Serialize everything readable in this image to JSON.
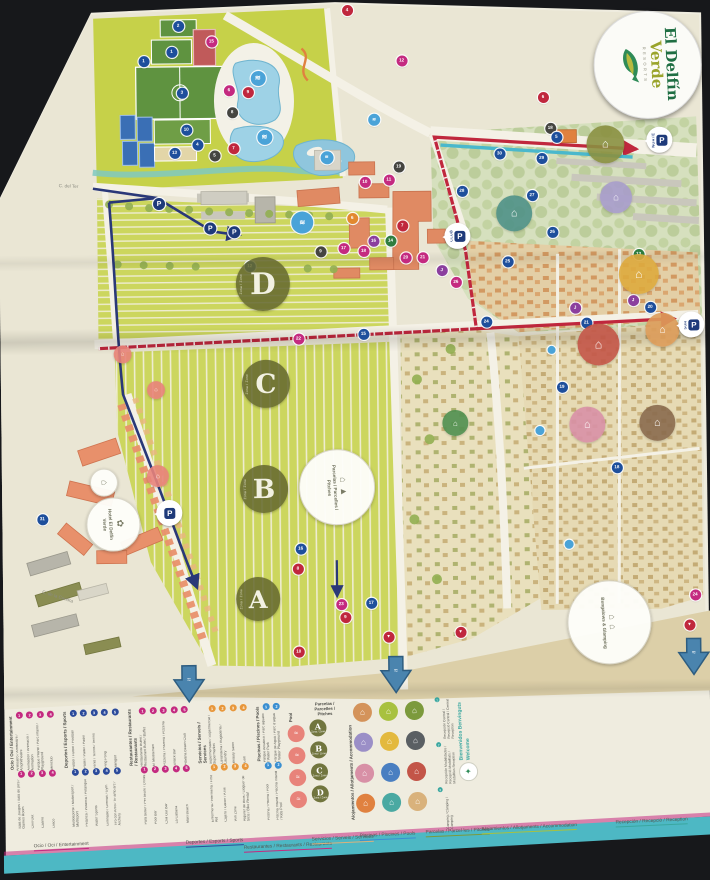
{
  "brand": {
    "line1": "El Delfín",
    "line2": "Verde",
    "tagline": "RESORTS",
    "dolphin_icon": "dolphin-icon"
  },
  "palette": {
    "b": "#1e4f9c",
    "lb": "#4aa3d8",
    "m": "#c42a80",
    "r": "#c0273d",
    "p": "#8b3f9e",
    "o": "#e2892f",
    "g": "#2f7d3f",
    "k": "#454541",
    "t": "#2ba6b4",
    "route_red": "#c0273d",
    "route_blue": "#2a3878",
    "route_teal": "#4ab8cc",
    "paper": "#efecdf",
    "lime": "#ccd65e",
    "sports": "#c6d149",
    "pool": "#9ed2e6"
  },
  "map": {
    "zone_circles": [
      {
        "letter": "D",
        "sub": "Zona / Zone",
        "x": 265,
        "y": 283,
        "r": 27
      },
      {
        "letter": "C",
        "sub": "Zona / Zone",
        "x": 267,
        "y": 383,
        "r": 24
      },
      {
        "letter": "B",
        "sub": "Zona / Zone",
        "x": 264,
        "y": 488,
        "r": 24
      },
      {
        "letter": "A",
        "sub": "Zona / Zone",
        "x": 257,
        "y": 598,
        "r": 22
      }
    ],
    "label_circles": [
      {
        "id": "pitches",
        "x": 336,
        "y": 486,
        "r": 37,
        "icons": "⌂ ▲",
        "text": "Parcelas / Parcelles / Pitches"
      },
      {
        "id": "bungalows",
        "x": 607,
        "y": 624,
        "r": 41,
        "icons": "⌂ ⌂",
        "text": "Bungalows & Glamping"
      },
      {
        "id": "hotel",
        "x": 112,
        "y": 521,
        "r": 26,
        "icons": "✿",
        "text": "Hotel El Delfín Verde"
      },
      {
        "id": "house",
        "x": 103,
        "y": 479,
        "r": 13,
        "icons": "⌂",
        "text": ""
      }
    ],
    "colored_circles": [
      {
        "x": 609,
        "y": 147,
        "r": 19,
        "c": "#8a9040",
        "g": "⌂"
      },
      {
        "x": 619,
        "y": 200,
        "r": 16,
        "c": "#a79ccb",
        "g": "⌂"
      },
      {
        "x": 517,
        "y": 215,
        "r": 18,
        "c": "#4f9187",
        "g": "⌂"
      },
      {
        "x": 641,
        "y": 277,
        "r": 20,
        "c": "#ddaa3e",
        "g": "⌂"
      },
      {
        "x": 600,
        "y": 347,
        "r": 21,
        "c": "#c35548",
        "g": "⌂"
      },
      {
        "x": 664,
        "y": 333,
        "r": 17,
        "c": "#dd9c5a",
        "g": "⌂"
      },
      {
        "x": 588,
        "y": 427,
        "r": 18,
        "c": "#d890a6",
        "g": "⌂"
      },
      {
        "x": 658,
        "y": 426,
        "r": 18,
        "c": "#8a6a4e",
        "g": "⌂"
      },
      {
        "x": 456,
        "y": 424,
        "r": 13,
        "c": "#4f8f4f",
        "g": "⌂"
      },
      {
        "x": 158,
        "y": 474,
        "r": 11,
        "c": "#e8837a",
        "g": "⌂"
      },
      {
        "x": 124,
        "y": 352,
        "r": 9,
        "c": "#e8837a",
        "g": "⌂"
      },
      {
        "x": 157,
        "y": 388,
        "r": 9,
        "c": "#e8837a",
        "g": "⌂"
      }
    ],
    "parkings": [
      {
        "label": "P",
        "name": "NORTE",
        "x": 650,
        "y": 130
      },
      {
        "label": "P",
        "name": "CLUB",
        "x": 447,
        "y": 224
      },
      {
        "label": "P",
        "name": "SUR",
        "x": 680,
        "y": 315
      },
      {
        "label": "P",
        "name": "",
        "x": 156,
        "y": 498
      }
    ],
    "p_dots": [
      {
        "x": 162,
        "y": 202
      },
      {
        "x": 213,
        "y": 227
      },
      {
        "x": 237,
        "y": 231
      }
    ],
    "streets": [
      {
        "text": "C. del Ter",
        "x": 62,
        "y": 180,
        "rot": 3
      },
      {
        "text": "C. de la Cendra",
        "x": 2,
        "y": 238,
        "rot": 90
      },
      {
        "text": "C. de la Cendra",
        "x": 42,
        "y": 586,
        "rot": 18
      }
    ],
    "beach_arrows": [
      {
        "x": 170,
        "y": 662
      },
      {
        "x": 377,
        "y": 655
      },
      {
        "x": 675,
        "y": 640
      }
    ],
    "markers": [
      {
        "x": 183,
        "y": 24,
        "c": "b",
        "t": "2"
      },
      {
        "x": 176,
        "y": 50,
        "c": "b",
        "t": "1"
      },
      {
        "x": 148,
        "y": 59,
        "c": "b",
        "t": "1"
      },
      {
        "x": 186,
        "y": 91,
        "c": "b",
        "t": "3"
      },
      {
        "x": 190,
        "y": 128,
        "c": "b",
        "t": "10"
      },
      {
        "x": 201,
        "y": 143,
        "c": "b",
        "t": "4"
      },
      {
        "x": 178,
        "y": 151,
        "c": "b",
        "t": "13"
      },
      {
        "x": 216,
        "y": 40,
        "c": "m",
        "t": "15"
      },
      {
        "x": 233,
        "y": 89,
        "c": "m",
        "t": "6"
      },
      {
        "x": 252,
        "y": 91,
        "c": "r",
        "t": "9"
      },
      {
        "x": 236,
        "y": 111,
        "c": "k",
        "t": "8"
      },
      {
        "x": 237,
        "y": 147,
        "c": "r",
        "t": "7"
      },
      {
        "x": 218,
        "y": 154,
        "c": "k",
        "t": "5"
      },
      {
        "x": 262,
        "y": 77,
        "c": "lb",
        "t": "≋",
        "s": 15
      },
      {
        "x": 268,
        "y": 136,
        "c": "lb",
        "t": "≋",
        "s": 15
      },
      {
        "x": 305,
        "y": 222,
        "c": "lb",
        "t": "≋",
        "s": 22
      },
      {
        "x": 330,
        "y": 157,
        "c": "lb",
        "t": "≋",
        "s": 13
      },
      {
        "x": 378,
        "y": 120,
        "c": "lb",
        "t": "≋",
        "s": 12
      },
      {
        "x": 352,
        "y": 10,
        "c": "r",
        "t": "4"
      },
      {
        "x": 406,
        "y": 61,
        "c": "m",
        "t": "12"
      },
      {
        "x": 547,
        "y": 99,
        "c": "r",
        "t": "6"
      },
      {
        "x": 554,
        "y": 130,
        "c": "k",
        "t": "18"
      },
      {
        "x": 560,
        "y": 139,
        "c": "b",
        "t": "5"
      },
      {
        "x": 503,
        "y": 155,
        "c": "b",
        "t": "30"
      },
      {
        "x": 545,
        "y": 160,
        "c": "b",
        "t": "29"
      },
      {
        "x": 465,
        "y": 192,
        "c": "b",
        "t": "28"
      },
      {
        "x": 535,
        "y": 197,
        "c": "b",
        "t": "27"
      },
      {
        "x": 555,
        "y": 234,
        "c": "b",
        "t": "26"
      },
      {
        "x": 510,
        "y": 263,
        "c": "b",
        "t": "25"
      },
      {
        "x": 488,
        "y": 323,
        "c": "b",
        "t": "24"
      },
      {
        "x": 402,
        "y": 167,
        "c": "k",
        "t": "19"
      },
      {
        "x": 392,
        "y": 180,
        "c": "m",
        "t": "11"
      },
      {
        "x": 368,
        "y": 182,
        "c": "m",
        "t": "10"
      },
      {
        "x": 355,
        "y": 218,
        "c": "o",
        "t": "6"
      },
      {
        "x": 405,
        "y": 226,
        "c": "r",
        "t": "7"
      },
      {
        "x": 376,
        "y": 241,
        "c": "p",
        "t": "16"
      },
      {
        "x": 393,
        "y": 241,
        "c": "g",
        "t": "14"
      },
      {
        "x": 346,
        "y": 248,
        "c": "m",
        "t": "17"
      },
      {
        "x": 366,
        "y": 251,
        "c": "m",
        "t": "18"
      },
      {
        "x": 408,
        "y": 258,
        "c": "m",
        "t": "20"
      },
      {
        "x": 425,
        "y": 258,
        "c": "m",
        "t": "21"
      },
      {
        "x": 323,
        "y": 251,
        "c": "k",
        "t": "9"
      },
      {
        "x": 300,
        "y": 338,
        "c": "m",
        "t": "22"
      },
      {
        "x": 365,
        "y": 334,
        "c": "b",
        "t": "15"
      },
      {
        "x": 444,
        "y": 271,
        "c": "p",
        "t": "J"
      },
      {
        "x": 458,
        "y": 283,
        "c": "m",
        "t": "26"
      },
      {
        "x": 577,
        "y": 310,
        "c": "p",
        "t": "J"
      },
      {
        "x": 635,
        "y": 303,
        "c": "p",
        "t": "J"
      },
      {
        "x": 588,
        "y": 325,
        "c": "b",
        "t": "21"
      },
      {
        "x": 652,
        "y": 310,
        "c": "b",
        "t": "20"
      },
      {
        "x": 641,
        "y": 257,
        "c": "g",
        "t": "13"
      },
      {
        "x": 563,
        "y": 389,
        "c": "b",
        "t": "19"
      },
      {
        "x": 617,
        "y": 470,
        "c": "b",
        "t": "18"
      },
      {
        "x": 694,
        "y": 598,
        "c": "m",
        "t": "24"
      },
      {
        "x": 553,
        "y": 352,
        "c": "lb",
        "t": "",
        "s": 8
      },
      {
        "x": 540,
        "y": 432,
        "c": "lb",
        "t": "",
        "s": 9
      },
      {
        "x": 568,
        "y": 546,
        "c": "lb",
        "t": "",
        "s": 9
      },
      {
        "x": 42,
        "y": 516,
        "c": "b",
        "t": "31"
      },
      {
        "x": 252,
        "y": 265,
        "c": "b",
        "t": "12"
      },
      {
        "x": 300,
        "y": 548,
        "c": "b",
        "t": "16"
      },
      {
        "x": 297,
        "y": 568,
        "c": "r",
        "t": "8"
      },
      {
        "x": 340,
        "y": 604,
        "c": "m",
        "t": "23"
      },
      {
        "x": 344,
        "y": 617,
        "c": "r",
        "t": "9"
      },
      {
        "x": 297,
        "y": 651,
        "c": "r",
        "t": "10"
      },
      {
        "x": 370,
        "y": 603,
        "c": "b",
        "t": "17"
      },
      {
        "x": 387,
        "y": 637,
        "c": "r",
        "t": "▼"
      },
      {
        "x": 459,
        "y": 633,
        "c": "r",
        "t": "▼"
      },
      {
        "x": 688,
        "y": 628,
        "c": "r",
        "t": "▼"
      }
    ]
  },
  "legend": {
    "sections": [
      {
        "id": "ocio",
        "type": "items",
        "header": "Ocio / Oci / Entertainment",
        "dot": "#c42a80",
        "rows": [
          [
            "Anfiteatro / Amfiteatre / Amphitheatre",
            "Animación / Animació / Animation",
            "Parque Infantil / Parc infantil / Playground",
            "Miniclub"
          ],
          [
            "Sala de Juegos / Sala de jocs / Games Room",
            "Chill Out",
            "Casino",
            "Disco"
          ]
        ]
      },
      {
        "id": "deportes",
        "type": "items",
        "header": "Deportes / Esports / Sports",
        "dot": "#2b4a9b",
        "rows": [
          [
            "Fútbol / Futbol / Football",
            "Pádel / Pàdel / Padel",
            "Tenis / Tennis / Tennis",
            "Ping Pong",
            "Minigolf"
          ],
          [
            "Multideporte / Multiesport / Multisport",
            "Petanca / Petanca / Petanque",
            "Water Sports",
            "Gimnasio / Gimnàs / Gym",
            "Tiro con Arco / Tir amb arc / Archery"
          ]
        ]
      },
      {
        "id": "restaurantes",
        "type": "items",
        "header": "Restaurantes / Restaurants / Restaurants",
        "dot": "#c42a80",
        "rows": [
          [
            "Restaurante Buffet / Restaurant Bufet / Buffet",
            "El Mediterrani",
            "Pizzería / Pizzeria / Pizzeria",
            "Snack Bar",
            "Havana Beach Club"
          ],
          [
            "Para beber / Per beure / Drinks",
            "Pool Bar",
            "Chill Out Bar",
            "La Cabana",
            "Maxi Beach"
          ]
        ]
      },
      {
        "id": "servicios",
        "type": "items",
        "header": "Servicios / Serveis / Services",
        "dot": "#e8973b",
        "rows": [
          [
            "Supermercado / Supermercat / Supermarket",
            "Lavandería / Bugaderia / Laundry",
            "Beauty Salon",
            "Golf"
          ],
          [
            "Enfermería / Infermeria / First Aid",
            "Cajero / Caixer / ATM",
            "Wifi Zone",
            "Alquiler de Bicis / Lloguer de bicis / Bike Rental"
          ]
        ]
      },
      {
        "id": "piscinas",
        "type": "items",
        "header": "Piscinas / Piscines / Pools",
        "dot": "#3a8fd1",
        "rows": [
          [
            "Parque Acuático / Parc aquàtic / Water Park",
            "Parque de Agua / Parc d'aigua / Water Playground"
          ],
          [
            "Piscina / Piscina / Pool",
            "Piscina Infantil / Piscina infantil / Kids Pool"
          ]
        ]
      },
      {
        "id": "pool-circles",
        "type": "pools",
        "header": "Pool",
        "circles": 4
      },
      {
        "id": "pitches",
        "type": "zones",
        "header": "Parcelas / Parcelles / Pitches",
        "zones": [
          "A",
          "B",
          "C",
          "D"
        ],
        "zone_sub": "Zona / Zone"
      },
      {
        "id": "alojamientos",
        "type": "accommodation",
        "header": "Alojamientos / Allotjaments / Accommodation",
        "colors": [
          "#d4935a",
          "#a8c13f",
          "#7c9a3c",
          "#9b8fc7",
          "#e3b93e",
          "#5a5f63",
          "#d890a6",
          "#4a7fc1",
          "#c35548",
          "#e0813f",
          "#4aa9a2",
          "#d9b27c"
        ]
      },
      {
        "id": "welcome",
        "type": "welcome",
        "title_lines": [
          "Bienvenidos",
          "Benvinguts",
          "Welcome"
        ],
        "notes": [
          "Recepción Central / Recepció Central / Central Reception",
          "Recepción Modalidades / Recepció Modalitats / Modalities Reception",
          "Camping / Càmping / Camping"
        ],
        "brand_icon": "dolphin-icon"
      }
    ],
    "footer_labels": [
      {
        "text": "Ocio / Oci / Entertainment",
        "x": 30,
        "y": 840,
        "c": "#c42a80"
      },
      {
        "text": "Deportes / Esports / Sports",
        "x": 182,
        "y": 838,
        "c": "#2b4a9b"
      },
      {
        "text": "Restaurantes / Restaurants / Restaurants",
        "x": 240,
        "y": 843,
        "c": "#c42a80"
      },
      {
        "text": "Servicios / Serveis / Services",
        "x": 308,
        "y": 836,
        "c": "#d9b27c"
      },
      {
        "text": "Piscinas / Piscines / Pools",
        "x": 356,
        "y": 833,
        "c": "#3a8fd1"
      },
      {
        "text": "Parcelas / Parcel·les / Pitches",
        "x": 422,
        "y": 830,
        "c": "#7c9a3c"
      },
      {
        "text": "Alojamientos / Allotjaments / Accommodation",
        "x": 478,
        "y": 827,
        "c": "#a8c13f"
      },
      {
        "text": "Recepción / Recepció / Reception",
        "x": 612,
        "y": 822,
        "c": "#3aa7a0"
      }
    ]
  }
}
